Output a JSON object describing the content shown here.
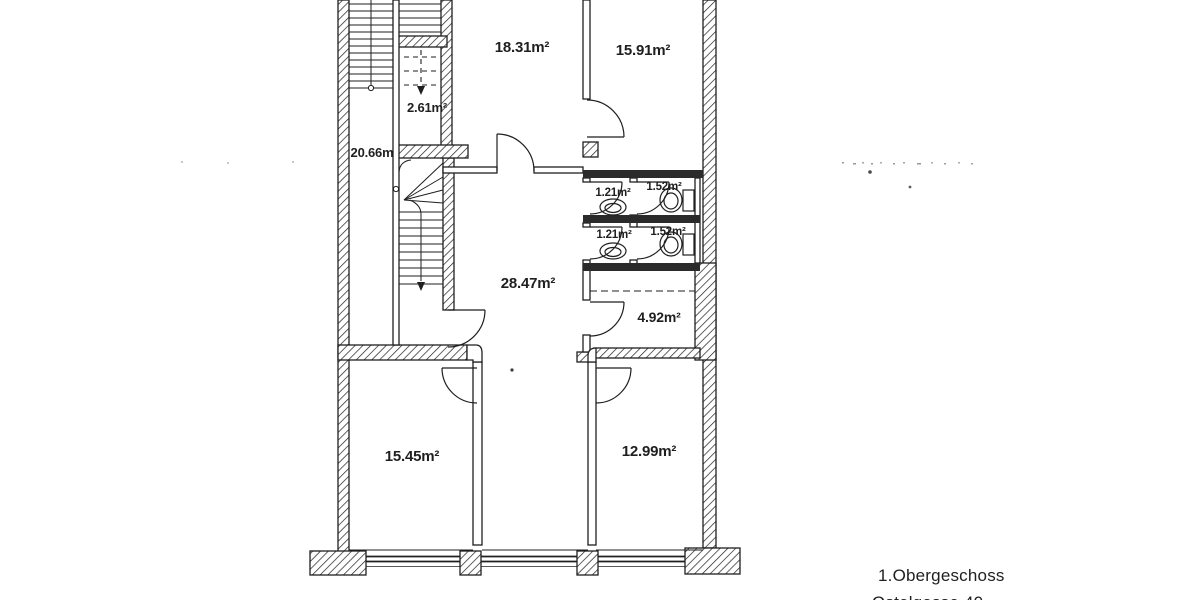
{
  "colors": {
    "ink": "#1f1f1f",
    "paper": "#ffffff",
    "wall_dark": "#2b2b2b"
  },
  "rooms": {
    "top_left_room": {
      "area_label": "18.31m²"
    },
    "top_right_room": {
      "area_label": "15.91m²"
    },
    "shaft": {
      "area_label": "2.61m²"
    },
    "stair_hall": {
      "area_label": "20.66m"
    },
    "bath_upper_left": {
      "area_label": "1.21m²"
    },
    "bath_upper_right": {
      "area_label": "1.52m²"
    },
    "bath_lower_left": {
      "area_label": "1.21m²"
    },
    "bath_lower_right": {
      "area_label": "1.52m²"
    },
    "hallway": {
      "area_label": "28.47m²"
    },
    "storage": {
      "area_label": "4.92m²"
    },
    "bottom_left_room": {
      "area_label": "15.45m²"
    },
    "bottom_right_room": {
      "area_label": "12.99m²"
    }
  },
  "caption": {
    "floor": "1.Obergeschoss",
    "address_partial": "Ostelgasse  40"
  }
}
